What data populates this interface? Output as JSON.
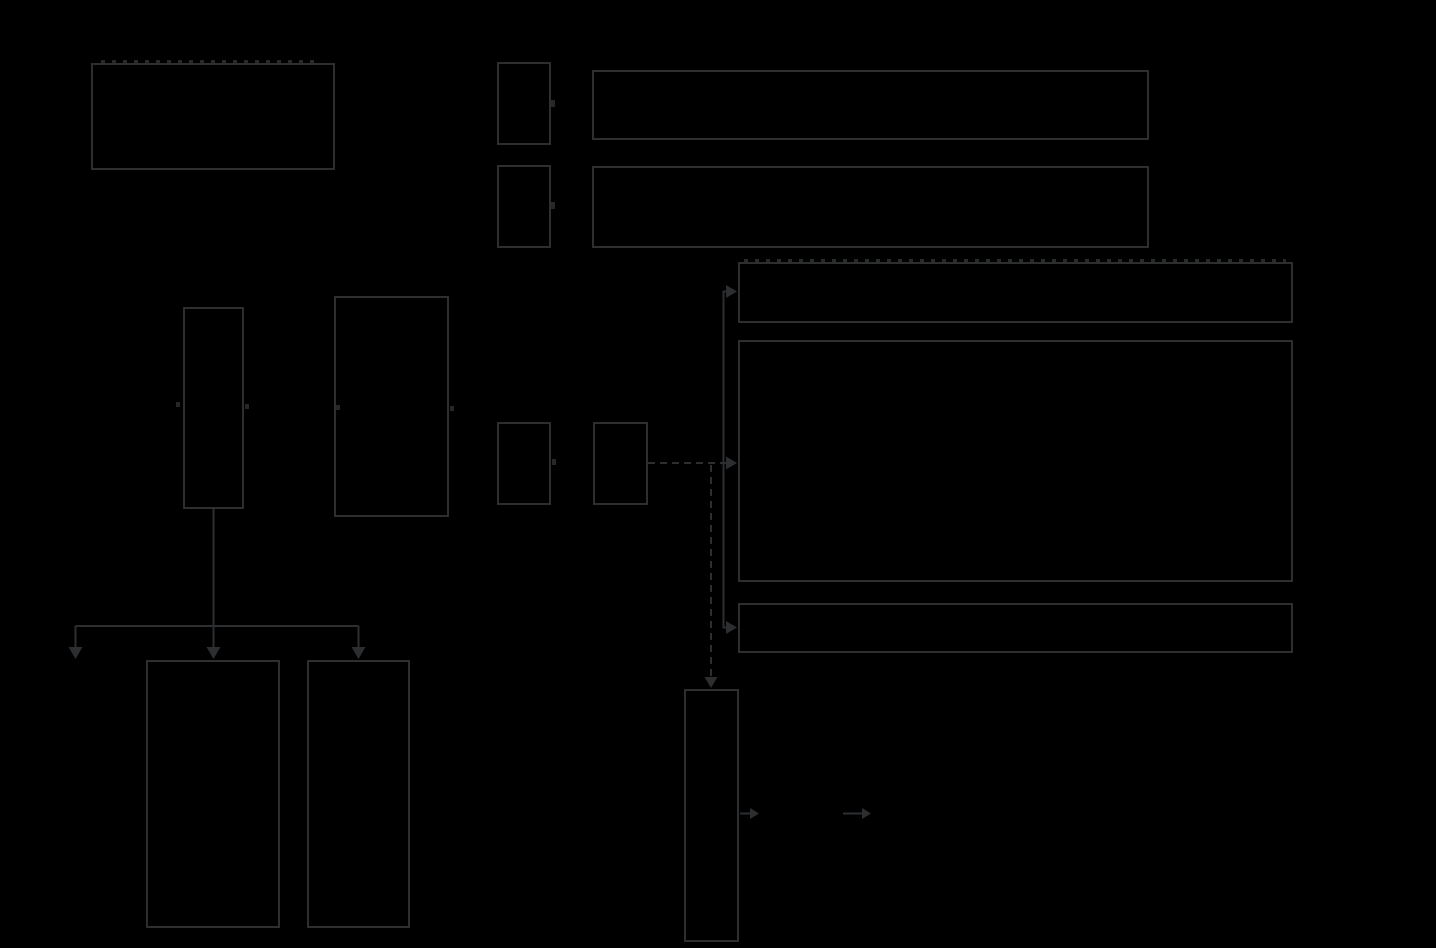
{
  "canvas": {
    "width_px": 1436,
    "height_px": 948
  },
  "theme": {
    "bg": "#000000",
    "stroke": "#2c2e2f"
  },
  "diagram": {
    "type": "flow-diagram",
    "visible_text": "",
    "labels_visible": false,
    "nodes": [
      {
        "id": "box-top-left",
        "shape": "rectangle"
      },
      {
        "id": "legend-swatch-1",
        "shape": "small-rectangle"
      },
      {
        "id": "legend-bar-1",
        "shape": "wide-rectangle"
      },
      {
        "id": "legend-swatch-2",
        "shape": "small-rectangle"
      },
      {
        "id": "legend-bar-2",
        "shape": "wide-rectangle"
      },
      {
        "id": "box-left-narrow",
        "shape": "tall-rectangle"
      },
      {
        "id": "box-left-wide",
        "shape": "tall-rectangle"
      },
      {
        "id": "box-small-1",
        "shape": "small-rectangle"
      },
      {
        "id": "box-small-2",
        "shape": "small-rectangle"
      },
      {
        "id": "bar-right-top",
        "shape": "wide-rectangle"
      },
      {
        "id": "panel-right-large",
        "shape": "large-rectangle"
      },
      {
        "id": "bar-right-bottom",
        "shape": "wide-rectangle"
      },
      {
        "id": "box-bottom-left-1",
        "shape": "tall-rectangle"
      },
      {
        "id": "box-bottom-left-2",
        "shape": "tall-rectangle"
      },
      {
        "id": "column-bottom-center",
        "shape": "tall-narrow-rectangle"
      }
    ],
    "edges": [
      {
        "from": "box-left-narrow",
        "to": "fan-out-junction",
        "style": "solid"
      },
      {
        "from": "fan-out-junction",
        "to": "unlabeled-left",
        "style": "solid-arrow-down"
      },
      {
        "from": "fan-out-junction",
        "to": "box-bottom-left-1",
        "style": "solid-arrow-down"
      },
      {
        "from": "fan-out-junction",
        "to": "box-bottom-left-2",
        "style": "solid-arrow-down"
      },
      {
        "from": "box-small-2",
        "to": "bar-right-top",
        "style": "solid-arrow-right"
      },
      {
        "from": "box-small-2",
        "to": "panel-right-large",
        "style": "dashed-arrow-right"
      },
      {
        "from": "box-small-2",
        "to": "bar-right-bottom",
        "style": "solid-arrow-right"
      },
      {
        "from": "box-small-2",
        "to": "column-bottom-center",
        "style": "dashed-arrow-down"
      },
      {
        "from": "column-bottom-center",
        "to": "unlabeled-right-1",
        "style": "solid-arrow-right"
      },
      {
        "from": "unlabeled-right-1",
        "to": "unlabeled-right-2",
        "style": "solid-arrow-right"
      }
    ]
  }
}
